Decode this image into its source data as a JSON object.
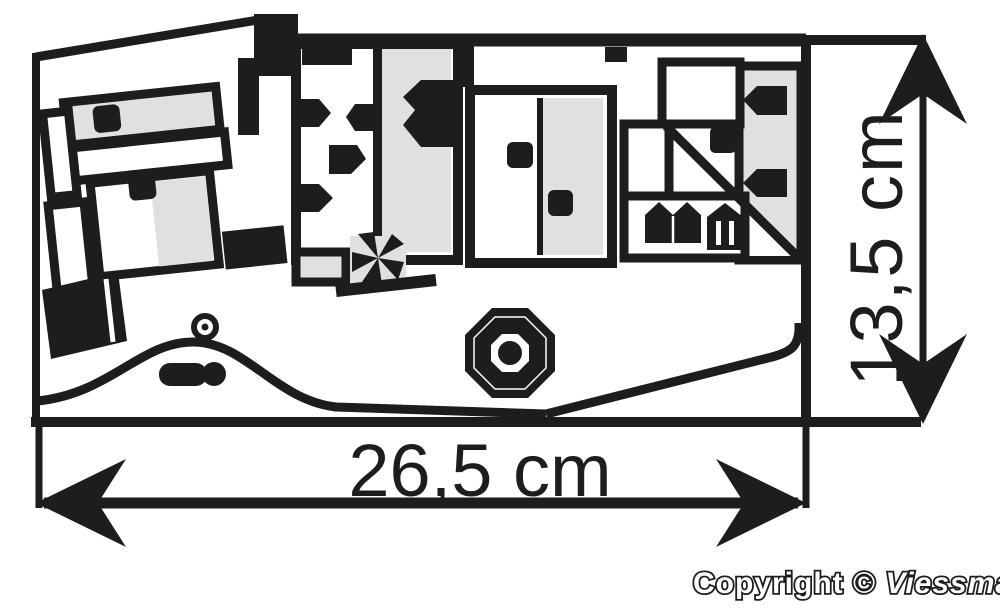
{
  "figure": {
    "kind": "model-kit footprint plan with overall dimensions"
  },
  "dimensions": {
    "width_label": "26,5 cm",
    "height_label": "13,5 cm"
  },
  "copyright": {
    "prefix": "Copyright © ",
    "brand": "Viessmann"
  },
  "colors": {
    "ink": "#1d1d1b",
    "building_gray": "#e0e0e0",
    "background": "#ffffff"
  }
}
